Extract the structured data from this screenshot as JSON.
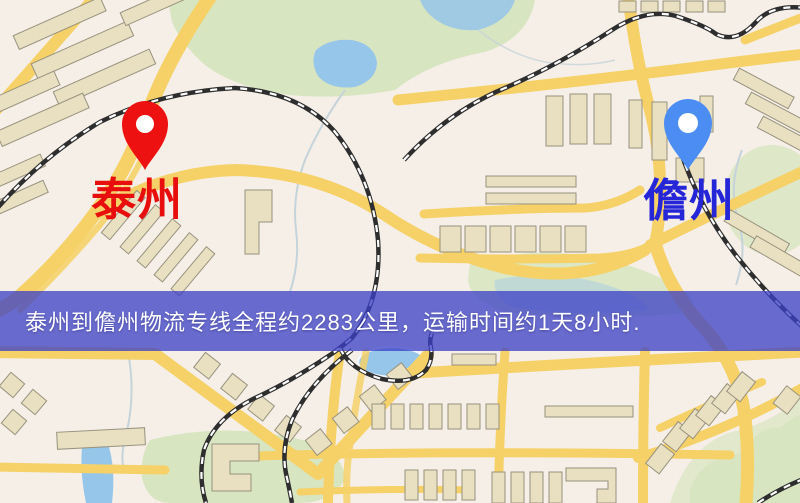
{
  "banner": {
    "text": "泰州到儋州物流专线全程约2283公里，运输时间约1天8小时.",
    "background": "rgba(59,64,198,0.76)",
    "text_color": "#ffffff"
  },
  "origin": {
    "name": "泰州",
    "pin_icon": "red-map-pin",
    "pin_color": "#ee1111",
    "pin_hole_color": "#ffffff",
    "label_color": "#e80e0e"
  },
  "destination": {
    "name": "儋州",
    "pin_icon": "blue-map-pin",
    "pin_color": "#4b8df2",
    "pin_hole_color": "#ffffff",
    "label_color": "#2626d9"
  },
  "map_palette": {
    "background": "#f5efe7",
    "road": "#f5d168",
    "park": "#d8e5c1",
    "water": "#96c6ea",
    "building": "#e9e0c2",
    "railway": "#2e2e2e",
    "stream": "#c5d3da"
  }
}
